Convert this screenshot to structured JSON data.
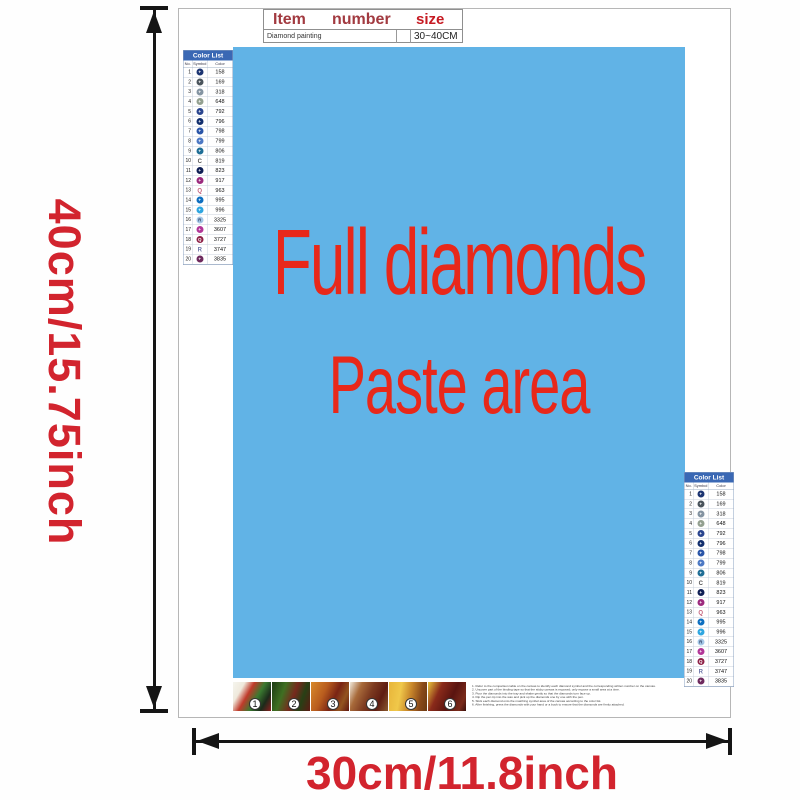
{
  "dimension_labels": {
    "height": "40cm/15.75inch",
    "width": "30cm/11.8inch"
  },
  "item_table": {
    "col_item": "Item",
    "col_number": "number",
    "col_size": "size",
    "item_value": "Diamond painting",
    "number_value": "",
    "size_value": "30~40CM"
  },
  "paste_area": {
    "line1": "Full diamonds",
    "line2": "Paste area"
  },
  "color_list": {
    "title": "Color List",
    "col_no": "No.",
    "col_symbol": "Symbol",
    "col_color": "Color",
    "rows": [
      {
        "no": "1",
        "code": "158",
        "style": "disc",
        "disc_color": "#1c3572",
        "glyph": "+",
        "glyph_color": "#ffffff"
      },
      {
        "no": "2",
        "code": "169",
        "style": "disc",
        "disc_color": "#4a545c",
        "glyph": "+",
        "glyph_color": "#ffffff"
      },
      {
        "no": "3",
        "code": "318",
        "style": "disc",
        "disc_color": "#8494a2",
        "glyph": "+",
        "glyph_color": "#ffffff"
      },
      {
        "no": "4",
        "code": "648",
        "style": "disc",
        "disc_color": "#93a090",
        "glyph": "+",
        "glyph_color": "#ffffff"
      },
      {
        "no": "5",
        "code": "792",
        "style": "disc",
        "disc_color": "#2a458f",
        "glyph": "+",
        "glyph_color": "#ffffff"
      },
      {
        "no": "6",
        "code": "796",
        "style": "disc",
        "disc_color": "#122f6e",
        "glyph": "+",
        "glyph_color": "#ffffff"
      },
      {
        "no": "7",
        "code": "798",
        "style": "disc",
        "disc_color": "#2a55a8",
        "glyph": "+",
        "glyph_color": "#ffffff"
      },
      {
        "no": "8",
        "code": "799",
        "style": "disc",
        "disc_color": "#4d79c4",
        "glyph": "+",
        "glyph_color": "#ffffff"
      },
      {
        "no": "9",
        "code": "806",
        "style": "disc",
        "disc_color": "#1f6e96",
        "glyph": "+",
        "glyph_color": "#ffffff"
      },
      {
        "no": "10",
        "code": "819",
        "style": "plain",
        "glyph": "C",
        "glyph_color": "#555555"
      },
      {
        "no": "11",
        "code": "823",
        "style": "disc",
        "disc_color": "#0f1f55",
        "glyph": "+",
        "glyph_color": "#ffffff"
      },
      {
        "no": "12",
        "code": "917",
        "style": "disc",
        "disc_color": "#9c2a7e",
        "glyph": "+",
        "glyph_color": "#ffffff"
      },
      {
        "no": "13",
        "code": "963",
        "style": "plain",
        "glyph": "Q",
        "glyph_color": "#c4607a"
      },
      {
        "no": "14",
        "code": "995",
        "style": "disc",
        "disc_color": "#0e6fc0",
        "glyph": "+",
        "glyph_color": "#ffffff"
      },
      {
        "no": "15",
        "code": "996",
        "style": "disc",
        "disc_color": "#2fa6e0",
        "glyph": "+",
        "glyph_color": "#ffffff"
      },
      {
        "no": "16",
        "code": "3325",
        "style": "disc",
        "disc_color": "#a5c8e8",
        "glyph": "R",
        "glyph_color": "#334466"
      },
      {
        "no": "17",
        "code": "3607",
        "style": "disc",
        "disc_color": "#b23698",
        "glyph": "+",
        "glyph_color": "#ffffff"
      },
      {
        "no": "18",
        "code": "3727",
        "style": "disc",
        "disc_color": "#8e2147",
        "glyph": "Q",
        "glyph_color": "#ffffff"
      },
      {
        "no": "19",
        "code": "3747",
        "style": "plain",
        "glyph": "R",
        "glyph_color": "#6b74a8"
      },
      {
        "no": "20",
        "code": "3835",
        "style": "disc",
        "disc_color": "#6e2a5e",
        "glyph": "+",
        "glyph_color": "#ffffff"
      }
    ]
  },
  "steps": {
    "numbers": [
      "1",
      "2",
      "3",
      "4",
      "5",
      "6"
    ]
  },
  "instructions": {
    "lines": [
      "1. Refer to the comparison table on the canvas to identify each diamond symbol and the corresponding written number on the canvas.",
      "2. Uncover part of the binding tape so that the sticky canvas is exposed; only expose a small area at a time.",
      "3. Pour the diamonds into the tray and shake gently so that the diamonds turn face up.",
      "4. Dip the pen tip into the wax and pick up the diamonds one by one with the pen.",
      "5. Stick each diamond onto the matching symbol area of the canvas according to the color list.",
      "6. After finishing, press the diamonds with your hand or a book to ensure that the diamonds are firmly attached."
    ]
  },
  "colors": {
    "paste_bg": "#61b3e6",
    "paste_text": "#e8281a",
    "dimension_text": "#d2242e",
    "table_header_red": "#a23a40",
    "size_red": "#c61a22",
    "list_header_blue": "#3a68b4",
    "arrow": "#151515"
  }
}
